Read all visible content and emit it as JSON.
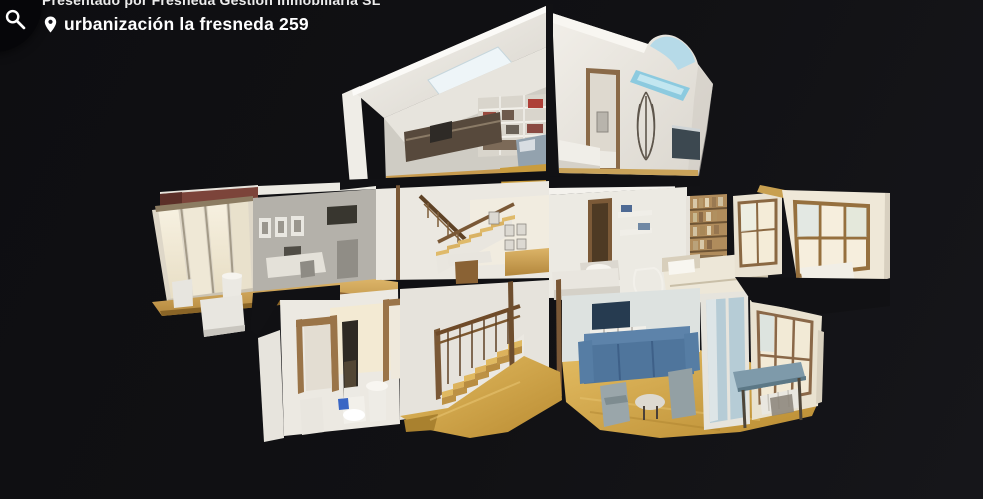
{
  "header": {
    "presented_by": "Presentado por Fresneda Gestión Inmobiliaria SL",
    "address": "urbanización la fresneda 259"
  },
  "toolbar": {
    "search_button": {
      "icon": "magnifier",
      "background": "#060609"
    }
  },
  "viewer": {
    "background": "#111114",
    "model_description": "3D dollhouse cutaway of a three-level house: attic with skylights and shelving, middle floor with curtained windows, switchback wooden staircase, bedrooms, ground floor hallway with bathroom fixtures, living room with blue sofa and dining table",
    "palette": {
      "walls": "#ece9e2",
      "wood_floor": "#c79a4e",
      "tile_floor": "#c8983a",
      "skylight": "#8ecbdf",
      "sofa": "#4f759c",
      "roof_band": "#7c443a"
    }
  }
}
